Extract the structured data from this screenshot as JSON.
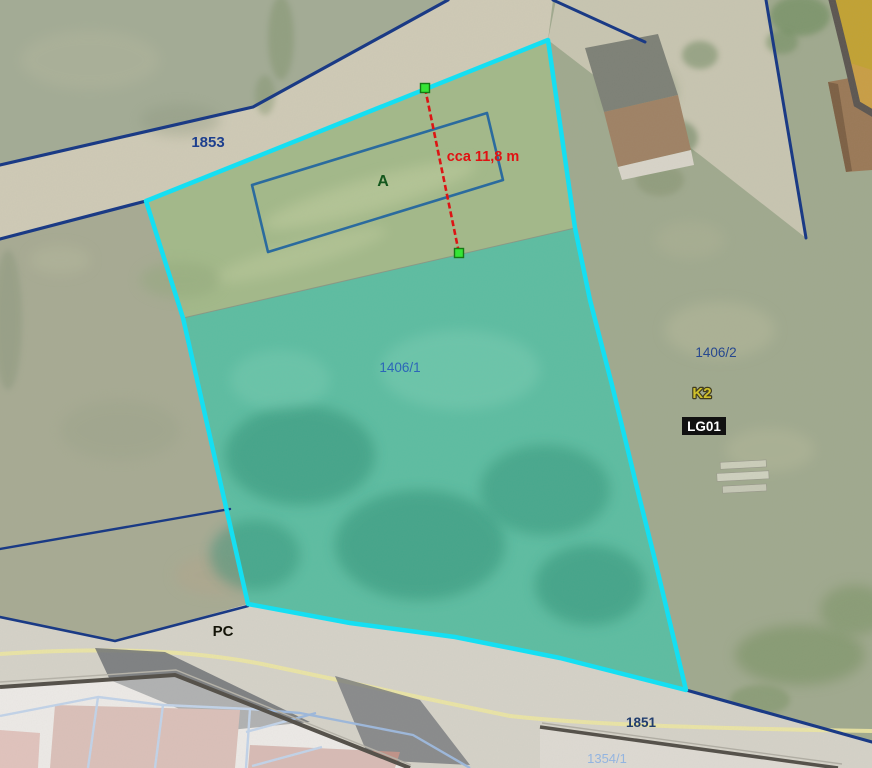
{
  "map": {
    "parcels": {
      "road_top_id": "1853",
      "selected_id": "1406/1",
      "right_id": "1406/2",
      "road_bottom_id": "1851",
      "bottom_partial_id": "1354/1"
    },
    "labels": {
      "building_plot": "A",
      "road_class": "PC",
      "zone_code": "K2",
      "zone_badge": "LG01"
    },
    "measurement": {
      "label": "cca 11,8 m"
    },
    "colors": {
      "selection_outline": "#15dff2",
      "selection_fill": "#5cbda1",
      "cadastral_line": "#1a3a85",
      "parcel_label_blue": "#2c66b8",
      "measurement_red": "#dd1414",
      "endpoint_green": "#35e535",
      "plot_outline_blue": "#2b6b9e",
      "zone_code_yellow": "#cfc02c"
    }
  }
}
